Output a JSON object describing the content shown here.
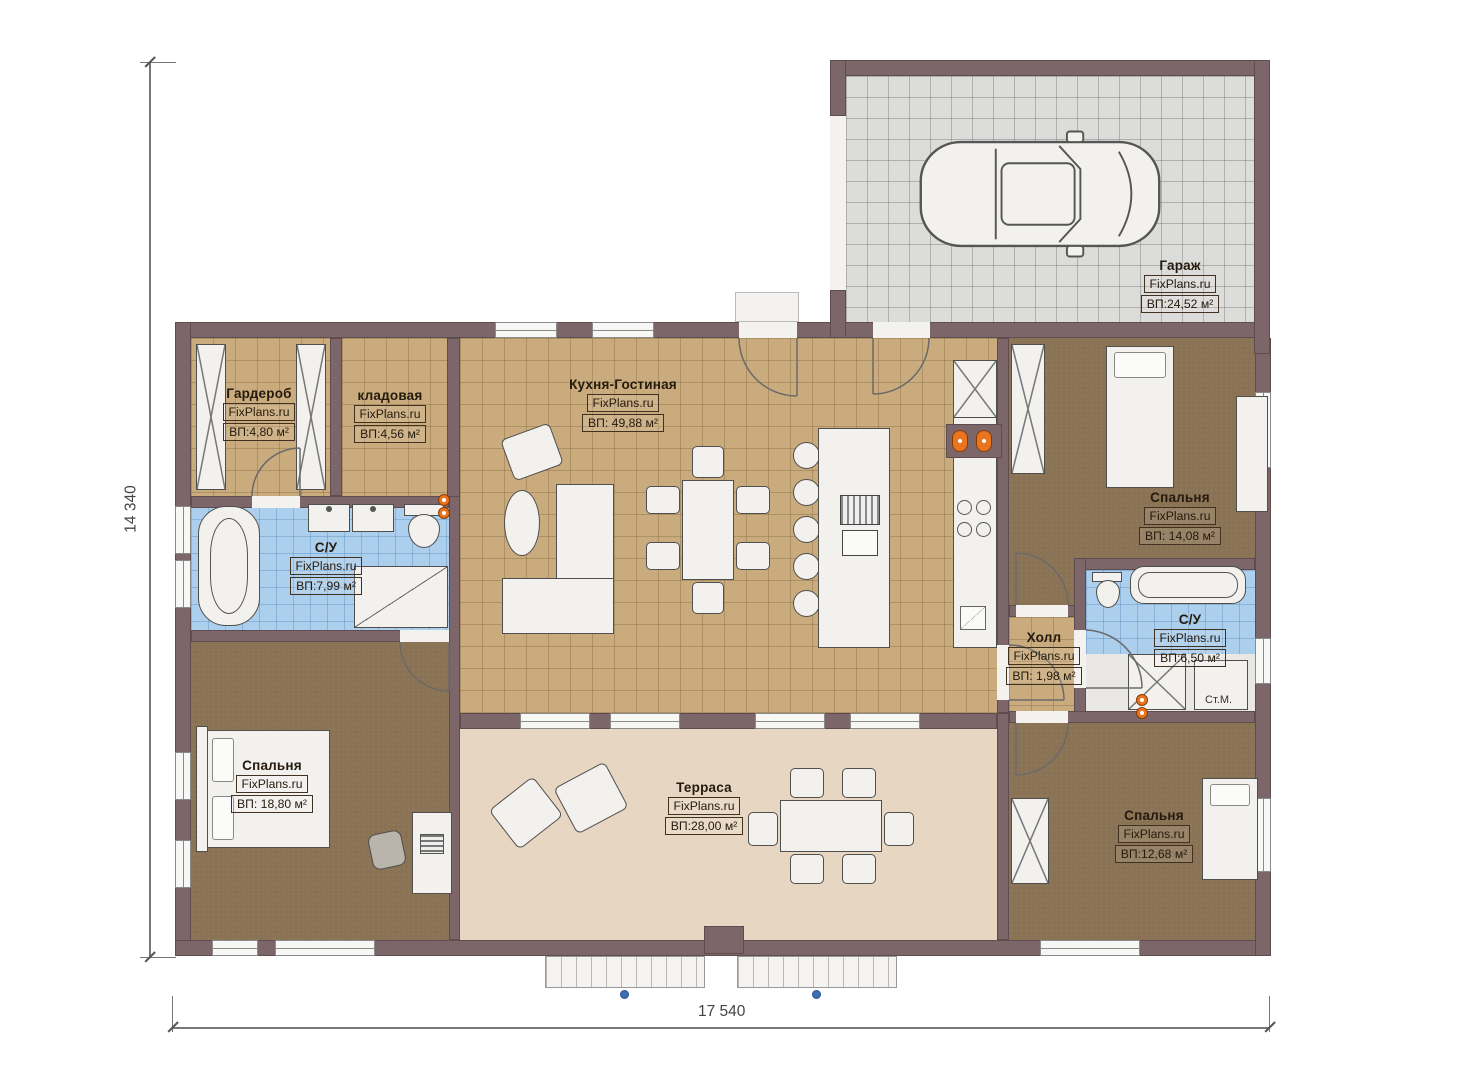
{
  "brand": "FixPlans.ru",
  "dimensions": {
    "width": "17 540",
    "height": "14 340"
  },
  "rooms": {
    "garage": {
      "name": "Гараж",
      "brand": "FixPlans.ru",
      "area": "ВП:24,52 м²"
    },
    "wardrobe": {
      "name": "Гардероб",
      "brand": "FixPlans.ru",
      "area": "ВП:4,80 м²"
    },
    "storage": {
      "name": "кладовая",
      "brand": "FixPlans.ru",
      "area": "ВП:4,56 м²"
    },
    "kitchen_living": {
      "name": "Кухня-Гостиная",
      "brand": "FixPlans.ru",
      "area": "ВП: 49,88 м²"
    },
    "bathroom_left": {
      "name": "С/У",
      "brand": "FixPlans.ru",
      "area": "ВП:7,99 м²"
    },
    "bedroom_top_right": {
      "name": "Спальня",
      "brand": "FixPlans.ru",
      "area": "ВП: 14,08 м²"
    },
    "bathroom_right": {
      "name": "С/У",
      "brand": "FixPlans.ru",
      "area": "ВП:6,50 м²"
    },
    "hall": {
      "name": "Холл",
      "brand": "FixPlans.ru",
      "area": "ВП: 1,98 м²"
    },
    "bedroom_bottom_left": {
      "name": "Спальня",
      "brand": "FixPlans.ru",
      "area": "ВП: 18,80 м²"
    },
    "terrace": {
      "name": "Терраса",
      "brand": "FixPlans.ru",
      "area": "ВП:28,00 м²"
    },
    "bedroom_bottom_right": {
      "name": "Спальня",
      "brand": "FixPlans.ru",
      "area": "ВП:12,68 м²"
    }
  },
  "fixtures": {
    "washing_machine": "Ст.М."
  },
  "colors": {
    "wall": "#7c6669",
    "tile_floor": "#c9ab7d",
    "carpet": "#8a7254",
    "bathroom_tile": "#abcfec",
    "terrace_floor": "#e7d7c2",
    "garage_floor": "#dcdcda",
    "accent_orange": "#e87420",
    "marker_blue": "#3a6fb5"
  }
}
